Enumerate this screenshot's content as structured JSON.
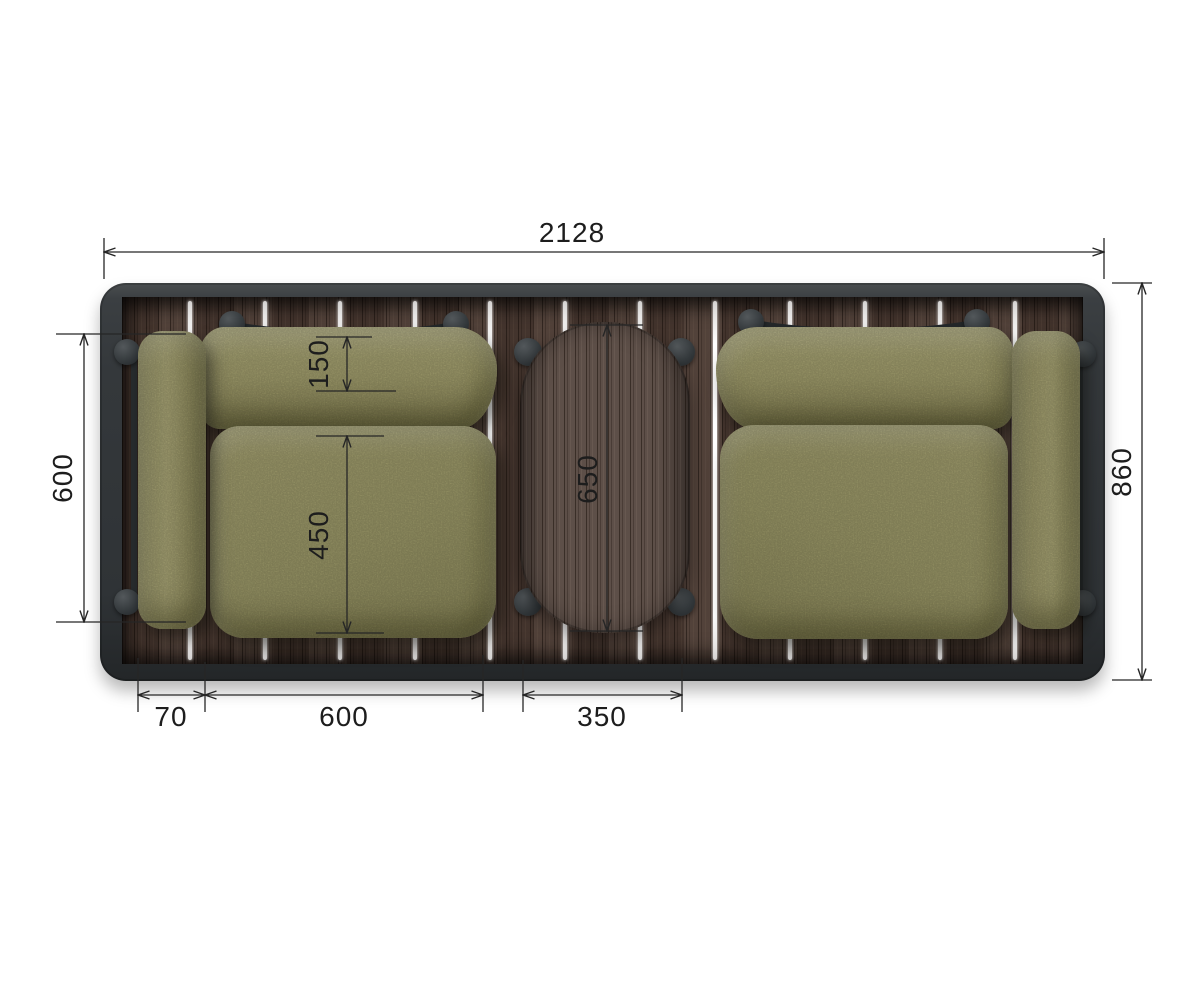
{
  "figure": {
    "type": "top-view dimensional drawing",
    "subject": "outdoor lounge set: two armchairs and an oval coffee table on a slatted wood platform"
  },
  "dim_labels": {
    "overall_width": "2128",
    "overall_depth": "860",
    "chair_outer_depth": "600",
    "backrest_depth": "150",
    "seat_depth": "450",
    "table_length": "650",
    "armrest_width": "70",
    "seat_width": "600",
    "table_width": "350"
  },
  "palette": {
    "background": "#ffffff",
    "frame": "#33373a",
    "deck_wood": "#4c3b33",
    "table_wood": "#5d4f48",
    "cushion_olive": "#a7a470",
    "dimension_line": "#262626"
  }
}
